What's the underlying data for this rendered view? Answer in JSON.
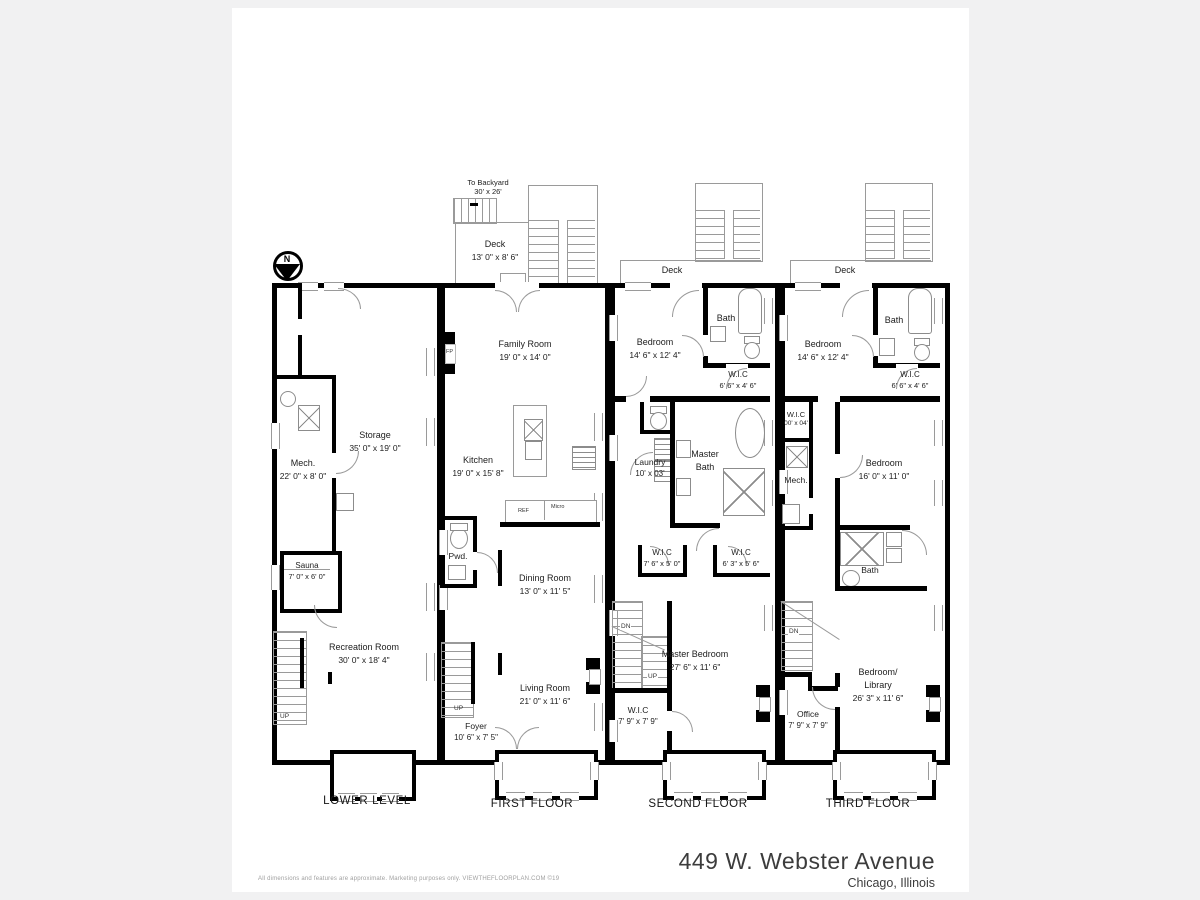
{
  "page": {
    "disclaimer": "All dimensions and features are approximate. Marketing purposes only. VIEWTHEFLOORPLAN.COM ©19",
    "address_line1": "449 W. Webster Avenue",
    "address_line2": "Chicago, Illinois"
  },
  "north": {
    "label": "N"
  },
  "floors": {
    "lower": {
      "title": "LOWER LEVEL",
      "rooms": {
        "storage": {
          "name": "Storage",
          "dims": "35' 0\" x 19' 0\""
        },
        "mech": {
          "name": "Mech.",
          "dims": "22' 0\" x 8' 0\""
        },
        "sauna": {
          "name": "Sauna",
          "dims": "7' 0\" x 6' 0\""
        },
        "recreation": {
          "name": "Recreation Room",
          "dims": "30' 0\" x 18' 4\""
        }
      },
      "labels": {
        "up": "UP"
      }
    },
    "first": {
      "title": "FIRST FLOOR",
      "rooms": {
        "deck": {
          "name": "Deck",
          "dims": "13' 0\" x 8' 6\""
        },
        "family": {
          "name": "Family Room",
          "dims": "19' 0\" x 14' 0\""
        },
        "kitchen": {
          "name": "Kitchen",
          "dims": "19' 0\" x 15' 8\""
        },
        "powder": {
          "name": "Pwd."
        },
        "dining": {
          "name": "Dining Room",
          "dims": "13' 0\" x 11' 5\""
        },
        "living": {
          "name": "Living Room",
          "dims": "21' 0\" x 11' 6\""
        },
        "foyer": {
          "name": "Foyer",
          "dims": "10' 6\" x 7' 5\""
        }
      },
      "labels": {
        "to_backyard": "To Backyard",
        "backyard_dims": "30' x 26'",
        "fp": "FP",
        "ref": "REF",
        "micro": "Micro",
        "up": "UP"
      }
    },
    "second": {
      "title": "SECOND FLOOR",
      "rooms": {
        "deck": {
          "name": "Deck"
        },
        "bedroom": {
          "name": "Bedroom",
          "dims": "14' 6\" x 12' 4\""
        },
        "bath": {
          "name": "Bath"
        },
        "wic_bedroom": {
          "name": "W.I.C",
          "dims": "6' 6\" x 4' 6\""
        },
        "laundry": {
          "name": "Laundry",
          "dims": "10' x 03'"
        },
        "master_bath": {
          "name": "Master",
          "name2": "Bath"
        },
        "wic_left": {
          "name": "W.I.C",
          "dims": "7' 6\" x 5' 0\""
        },
        "wic_right": {
          "name": "W.I.C",
          "dims": "6' 3\" x 5' 6\""
        },
        "master_bedroom": {
          "name": "Master Bedroom",
          "dims": "27' 6\" x 11' 6\""
        },
        "wic_lower": {
          "name": "W.I.C",
          "dims": "7' 9\" x 7' 9\""
        }
      },
      "labels": {
        "dn": "DN",
        "up": "UP"
      }
    },
    "third": {
      "title": "THIRD FLOOR",
      "rooms": {
        "deck": {
          "name": "Deck"
        },
        "bedroom": {
          "name": "Bedroom",
          "dims": "14' 6\" x 12' 4\""
        },
        "bath": {
          "name": "Bath"
        },
        "wic_bedroom": {
          "name": "W.I.C",
          "dims": "6' 6\" x 4' 6\""
        },
        "wic_small": {
          "name": "W.I.C",
          "dims": "00' x 04'"
        },
        "mech": {
          "name": "Mech."
        },
        "bedroom_mid": {
          "name": "Bedroom",
          "dims": "16' 0\" x 11' 0\""
        },
        "bath_mid": {
          "name": "Bath"
        },
        "office": {
          "name": "Office",
          "dims": "7' 9\" x 7' 9\""
        },
        "library": {
          "name": "Bedroom/",
          "name2": "Library",
          "dims": "26' 3\" x 11' 6\""
        }
      },
      "labels": {
        "dn": "DN"
      }
    }
  }
}
